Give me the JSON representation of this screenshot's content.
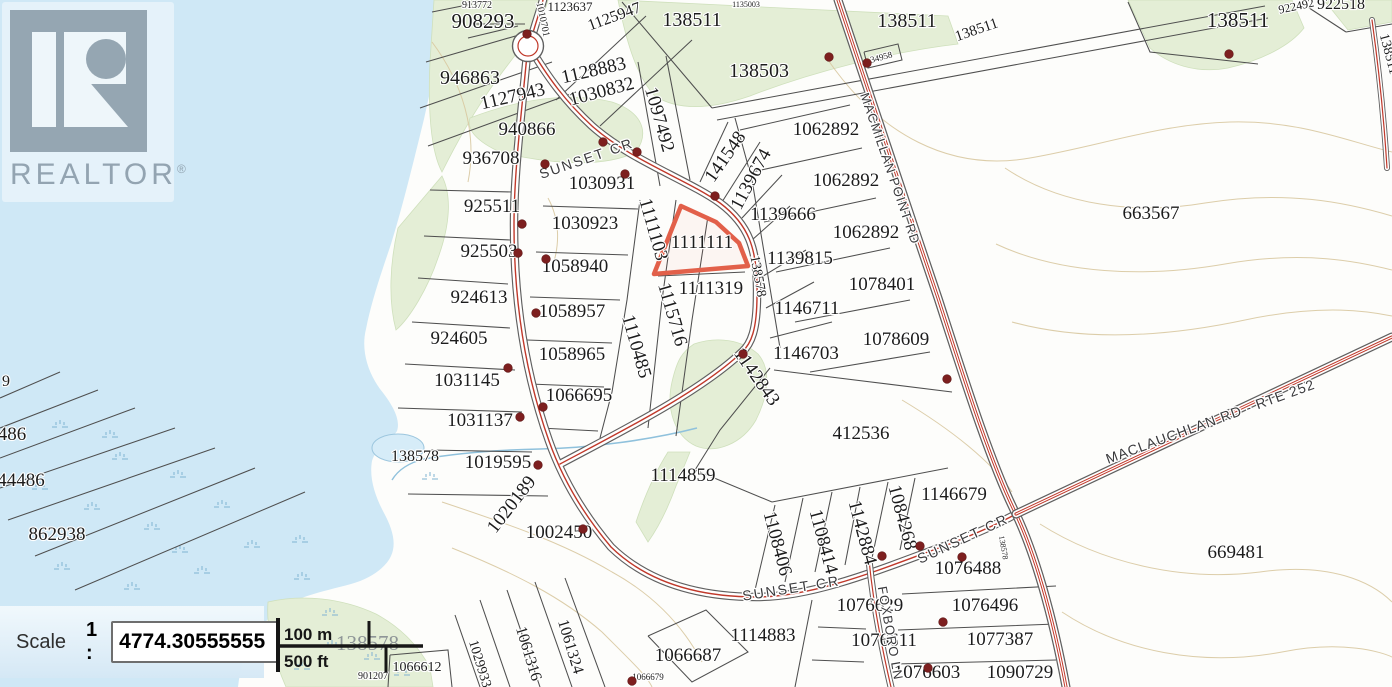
{
  "branding": {
    "logo_text": "REALTOR",
    "registered_mark": "®"
  },
  "scale_control": {
    "label": "Scale",
    "ratio_prefix": "1 :",
    "value": "4774.30555555"
  },
  "scale_bar": {
    "metric": "100 m",
    "imperial": "500 ft",
    "background_label": "138578"
  },
  "highlight": {
    "parcel_id": "1111111",
    "color": "#e2604a"
  },
  "map": {
    "colors": {
      "water": "#cfe8f6",
      "land": "#fdfdfb",
      "vegetation": "#e4eed6",
      "contour": "#d8c8a0",
      "parcel_line": "#4f4f4f",
      "road_centerline": "#c0392b",
      "highlight_outline": "#e2604a",
      "address_dot": "#7d1f1f"
    },
    "road_labels": [
      [
        "SUNSET CR",
        588,
        163,
        -19,
        14,
        2
      ],
      [
        "SUNSET CR",
        792,
        593,
        -9,
        14,
        2
      ],
      [
        "SUNSET CR",
        965,
        543,
        -25,
        14,
        2
      ],
      [
        "MACMILLAN POINT RD",
        886,
        170,
        71,
        13,
        1
      ],
      [
        "MACLAUCHLAN RD - RTE 252",
        1212,
        426,
        -20,
        14,
        1
      ],
      [
        "FOXBORO LN",
        886,
        634,
        80,
        13,
        1
      ]
    ],
    "parcel_labels": [
      [
        "913772",
        477,
        8,
        0,
        10
      ],
      [
        "908293",
        483,
        28,
        0,
        21
      ],
      [
        "1010701",
        540,
        20,
        78,
        10
      ],
      [
        "1123637",
        570,
        11,
        0,
        13
      ],
      [
        "1125947",
        616,
        21,
        -20,
        16
      ],
      [
        "1135003",
        746,
        7,
        0,
        8
      ],
      [
        "138511",
        692,
        26,
        0,
        20
      ],
      [
        "138511",
        907,
        27,
        0,
        20
      ],
      [
        "138511",
        978,
        34,
        -19,
        15
      ],
      [
        "922492",
        1297,
        10,
        -12,
        12
      ],
      [
        "922518",
        1341,
        9,
        0,
        16
      ],
      [
        "138511",
        1238,
        27,
        0,
        21
      ],
      [
        "138511",
        1385,
        55,
        75,
        14
      ],
      [
        "34958",
        882,
        60,
        -15,
        9
      ],
      [
        "946863",
        470,
        84,
        0,
        20
      ],
      [
        "1127943",
        514,
        102,
        -13,
        19
      ],
      [
        "1128883",
        595,
        76,
        -13,
        19
      ],
      [
        "1030832",
        603,
        97,
        -15,
        19
      ],
      [
        "138503",
        759,
        77,
        0,
        20
      ],
      [
        "940866",
        527,
        135,
        0,
        19
      ],
      [
        "1097492",
        654,
        121,
        74,
        19
      ],
      [
        "936708",
        491,
        164,
        0,
        19
      ],
      [
        "1030931",
        602,
        189,
        0,
        19
      ],
      [
        "141548",
        730,
        160,
        -55,
        19
      ],
      [
        "1139674",
        756,
        182,
        -62,
        19
      ],
      [
        "1062892",
        826,
        135,
        0,
        19
      ],
      [
        "1062892",
        846,
        186,
        0,
        19
      ],
      [
        "1062892",
        866,
        238,
        0,
        19
      ],
      [
        "1139666",
        783,
        220,
        0,
        19
      ],
      [
        "1139815",
        800,
        264,
        0,
        19
      ],
      [
        "1078401",
        882,
        290,
        0,
        19
      ],
      [
        "925511",
        492,
        212,
        0,
        19
      ],
      [
        "1030923",
        585,
        229,
        0,
        19
      ],
      [
        "1111103",
        648,
        231,
        74,
        19
      ],
      [
        "1111111",
        702,
        248,
        0,
        19
      ],
      [
        "925503",
        489,
        257,
        0,
        19
      ],
      [
        "1058940",
        575,
        272,
        0,
        19
      ],
      [
        "1111319",
        711,
        294,
        0,
        19
      ],
      [
        "138578",
        754,
        277,
        80,
        14
      ],
      [
        "924613",
        479,
        303,
        0,
        19
      ],
      [
        "1058957",
        572,
        317,
        0,
        19
      ],
      [
        "924605",
        459,
        344,
        0,
        19
      ],
      [
        "1058965",
        572,
        360,
        0,
        19
      ],
      [
        "1110485",
        631,
        348,
        74,
        19
      ],
      [
        "1115716",
        667,
        316,
        74,
        19
      ],
      [
        "1146711",
        807,
        314,
        0,
        19
      ],
      [
        "1146703",
        806,
        359,
        0,
        19
      ],
      [
        "1078609",
        896,
        345,
        0,
        19
      ],
      [
        "1031145",
        467,
        386,
        0,
        19
      ],
      [
        "1066695",
        579,
        401,
        0,
        19
      ],
      [
        "1031137",
        480,
        426,
        0,
        19
      ],
      [
        "1142843",
        752,
        380,
        55,
        19
      ],
      [
        "412536",
        861,
        439,
        0,
        19
      ],
      [
        "138578",
        415,
        461,
        0,
        16
      ],
      [
        "1019595",
        498,
        468,
        0,
        19
      ],
      [
        "1114859",
        683,
        481,
        0,
        19
      ],
      [
        "1020189",
        516,
        508,
        -52,
        19
      ],
      [
        "1002450",
        559,
        538,
        0,
        19
      ],
      [
        "1146679",
        954,
        500,
        0,
        19
      ],
      [
        "1108406",
        772,
        545,
        75,
        19
      ],
      [
        "1108414",
        818,
        543,
        75,
        19
      ],
      [
        "1142884",
        857,
        534,
        75,
        19
      ],
      [
        "1084268",
        897,
        519,
        75,
        19
      ],
      [
        "138578",
        1001,
        548,
        80,
        8
      ],
      [
        "1076488",
        968,
        574,
        0,
        19
      ],
      [
        "1076629",
        870,
        611,
        0,
        19
      ],
      [
        "1076496",
        985,
        611,
        0,
        19
      ],
      [
        "1076611",
        884,
        646,
        0,
        19
      ],
      [
        "1077387",
        1000,
        645,
        0,
        19
      ],
      [
        "1076603",
        927,
        678,
        0,
        19
      ],
      [
        "1090729",
        1020,
        678,
        0,
        19
      ],
      [
        "663567",
        1151,
        219,
        0,
        19
      ],
      [
        "669481",
        1236,
        558,
        0,
        19
      ],
      [
        "862938",
        57,
        540,
        0,
        19
      ],
      [
        "44486",
        21,
        486,
        0,
        19
      ],
      [
        "486",
        12,
        440,
        0,
        19
      ],
      [
        "9",
        6,
        386,
        0,
        16
      ],
      [
        "1114883",
        763,
        641,
        0,
        19
      ],
      [
        "1066687",
        688,
        661,
        0,
        19
      ],
      [
        "1066679",
        648,
        680,
        0,
        9
      ],
      [
        "1066612",
        417,
        671,
        0,
        14
      ],
      [
        "901207",
        373,
        679,
        0,
        10
      ],
      [
        "1029933",
        476,
        665,
        73,
        14
      ],
      [
        "1061316",
        524,
        655,
        73,
        16
      ],
      [
        "1061324",
        566,
        648,
        73,
        16
      ]
    ],
    "address_dots": [
      [
        527,
        34
      ],
      [
        829,
        57
      ],
      [
        867,
        63
      ],
      [
        1229,
        54
      ],
      [
        603,
        142
      ],
      [
        637,
        152
      ],
      [
        625,
        174
      ],
      [
        545,
        164
      ],
      [
        522,
        224
      ],
      [
        518,
        253
      ],
      [
        546,
        259
      ],
      [
        536,
        313
      ],
      [
        508,
        368
      ],
      [
        543,
        407
      ],
      [
        520,
        417
      ],
      [
        715,
        196
      ],
      [
        743,
        354
      ],
      [
        947,
        379
      ],
      [
        538,
        465
      ],
      [
        583,
        529
      ],
      [
        882,
        556
      ],
      [
        920,
        546
      ],
      [
        962,
        557
      ],
      [
        943,
        622
      ],
      [
        928,
        668
      ],
      [
        632,
        681
      ]
    ]
  }
}
